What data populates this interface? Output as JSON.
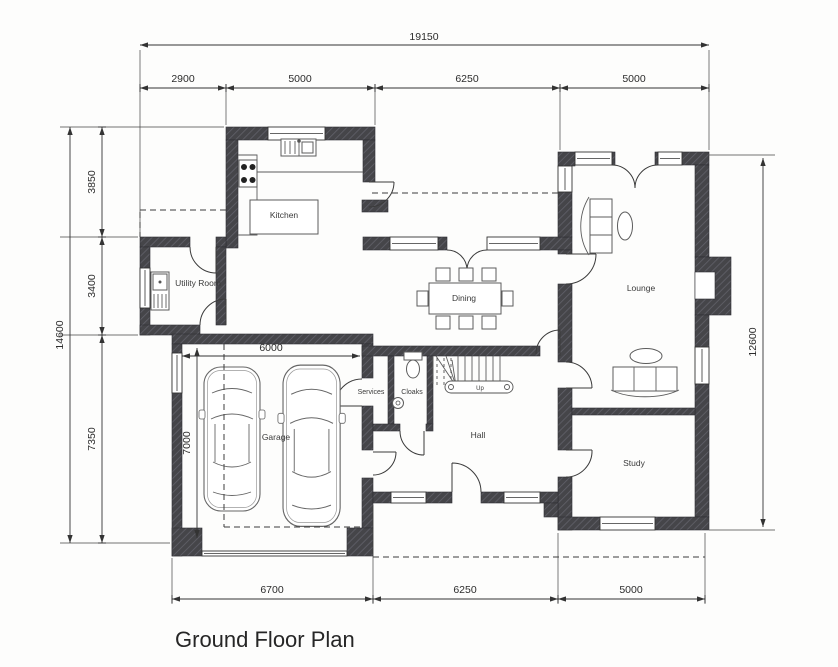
{
  "title": "Ground Floor Plan",
  "colors": {
    "wall_fill": "#454549",
    "wall_hatch": "#62626a",
    "line": "#333333",
    "background": "#fdfdfc"
  },
  "rooms": {
    "kitchen": "Kitchen",
    "utility": "Utility Room",
    "dining": "Dining",
    "lounge": "Lounge",
    "garage": "Garage",
    "services": "Services",
    "cloaks": "Cloaks",
    "hall": "Hall",
    "study": "Study"
  },
  "stairs": {
    "up": "Up"
  },
  "dims": {
    "top_overall": "19150",
    "top_segments": [
      "2900",
      "5000",
      "6250",
      "5000"
    ],
    "left_overall": "14600",
    "left_segments": [
      "3850",
      "3400",
      "7350"
    ],
    "right_overall": "12600",
    "bottom_segments": [
      "6700",
      "6250",
      "5000"
    ],
    "garage_width": "6000",
    "garage_depth": "7000"
  }
}
